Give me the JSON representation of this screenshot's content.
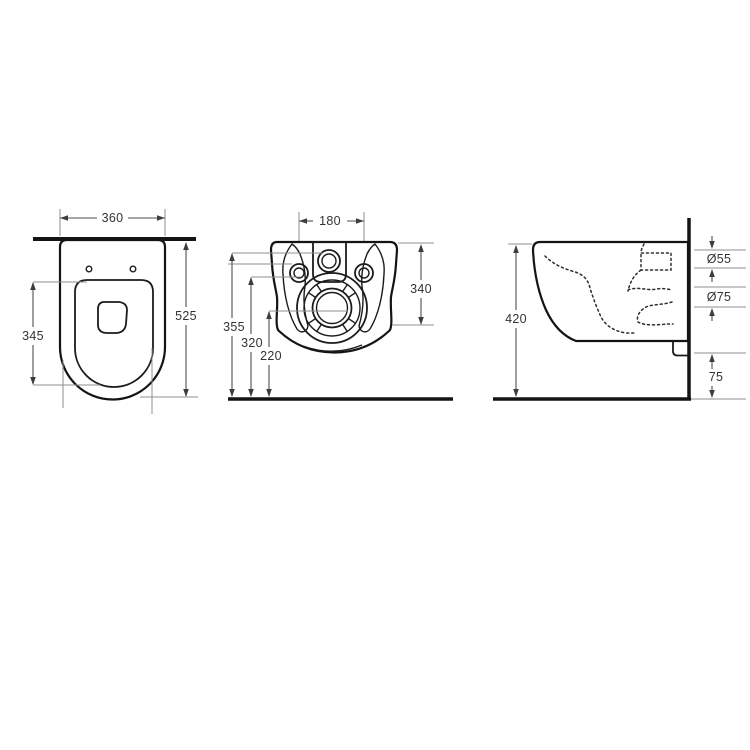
{
  "drawing": {
    "background": "#ffffff",
    "line_color": "#141414",
    "dim_line_color": "#4f4f4f",
    "ext_line_color": "#8f8f8f",
    "text_color": "#333333"
  },
  "top_view": {
    "width": "360",
    "depth": "525",
    "seat_depth": "345"
  },
  "back_view": {
    "bolt_spacing": "180",
    "side_height": "340",
    "height_total": "355",
    "height_bolts": "320",
    "height_outlet": "220"
  },
  "side_view": {
    "height": "420",
    "inlet_diameter": "Ø55",
    "outlet_diameter": "Ø75",
    "floor_gap": "75"
  }
}
